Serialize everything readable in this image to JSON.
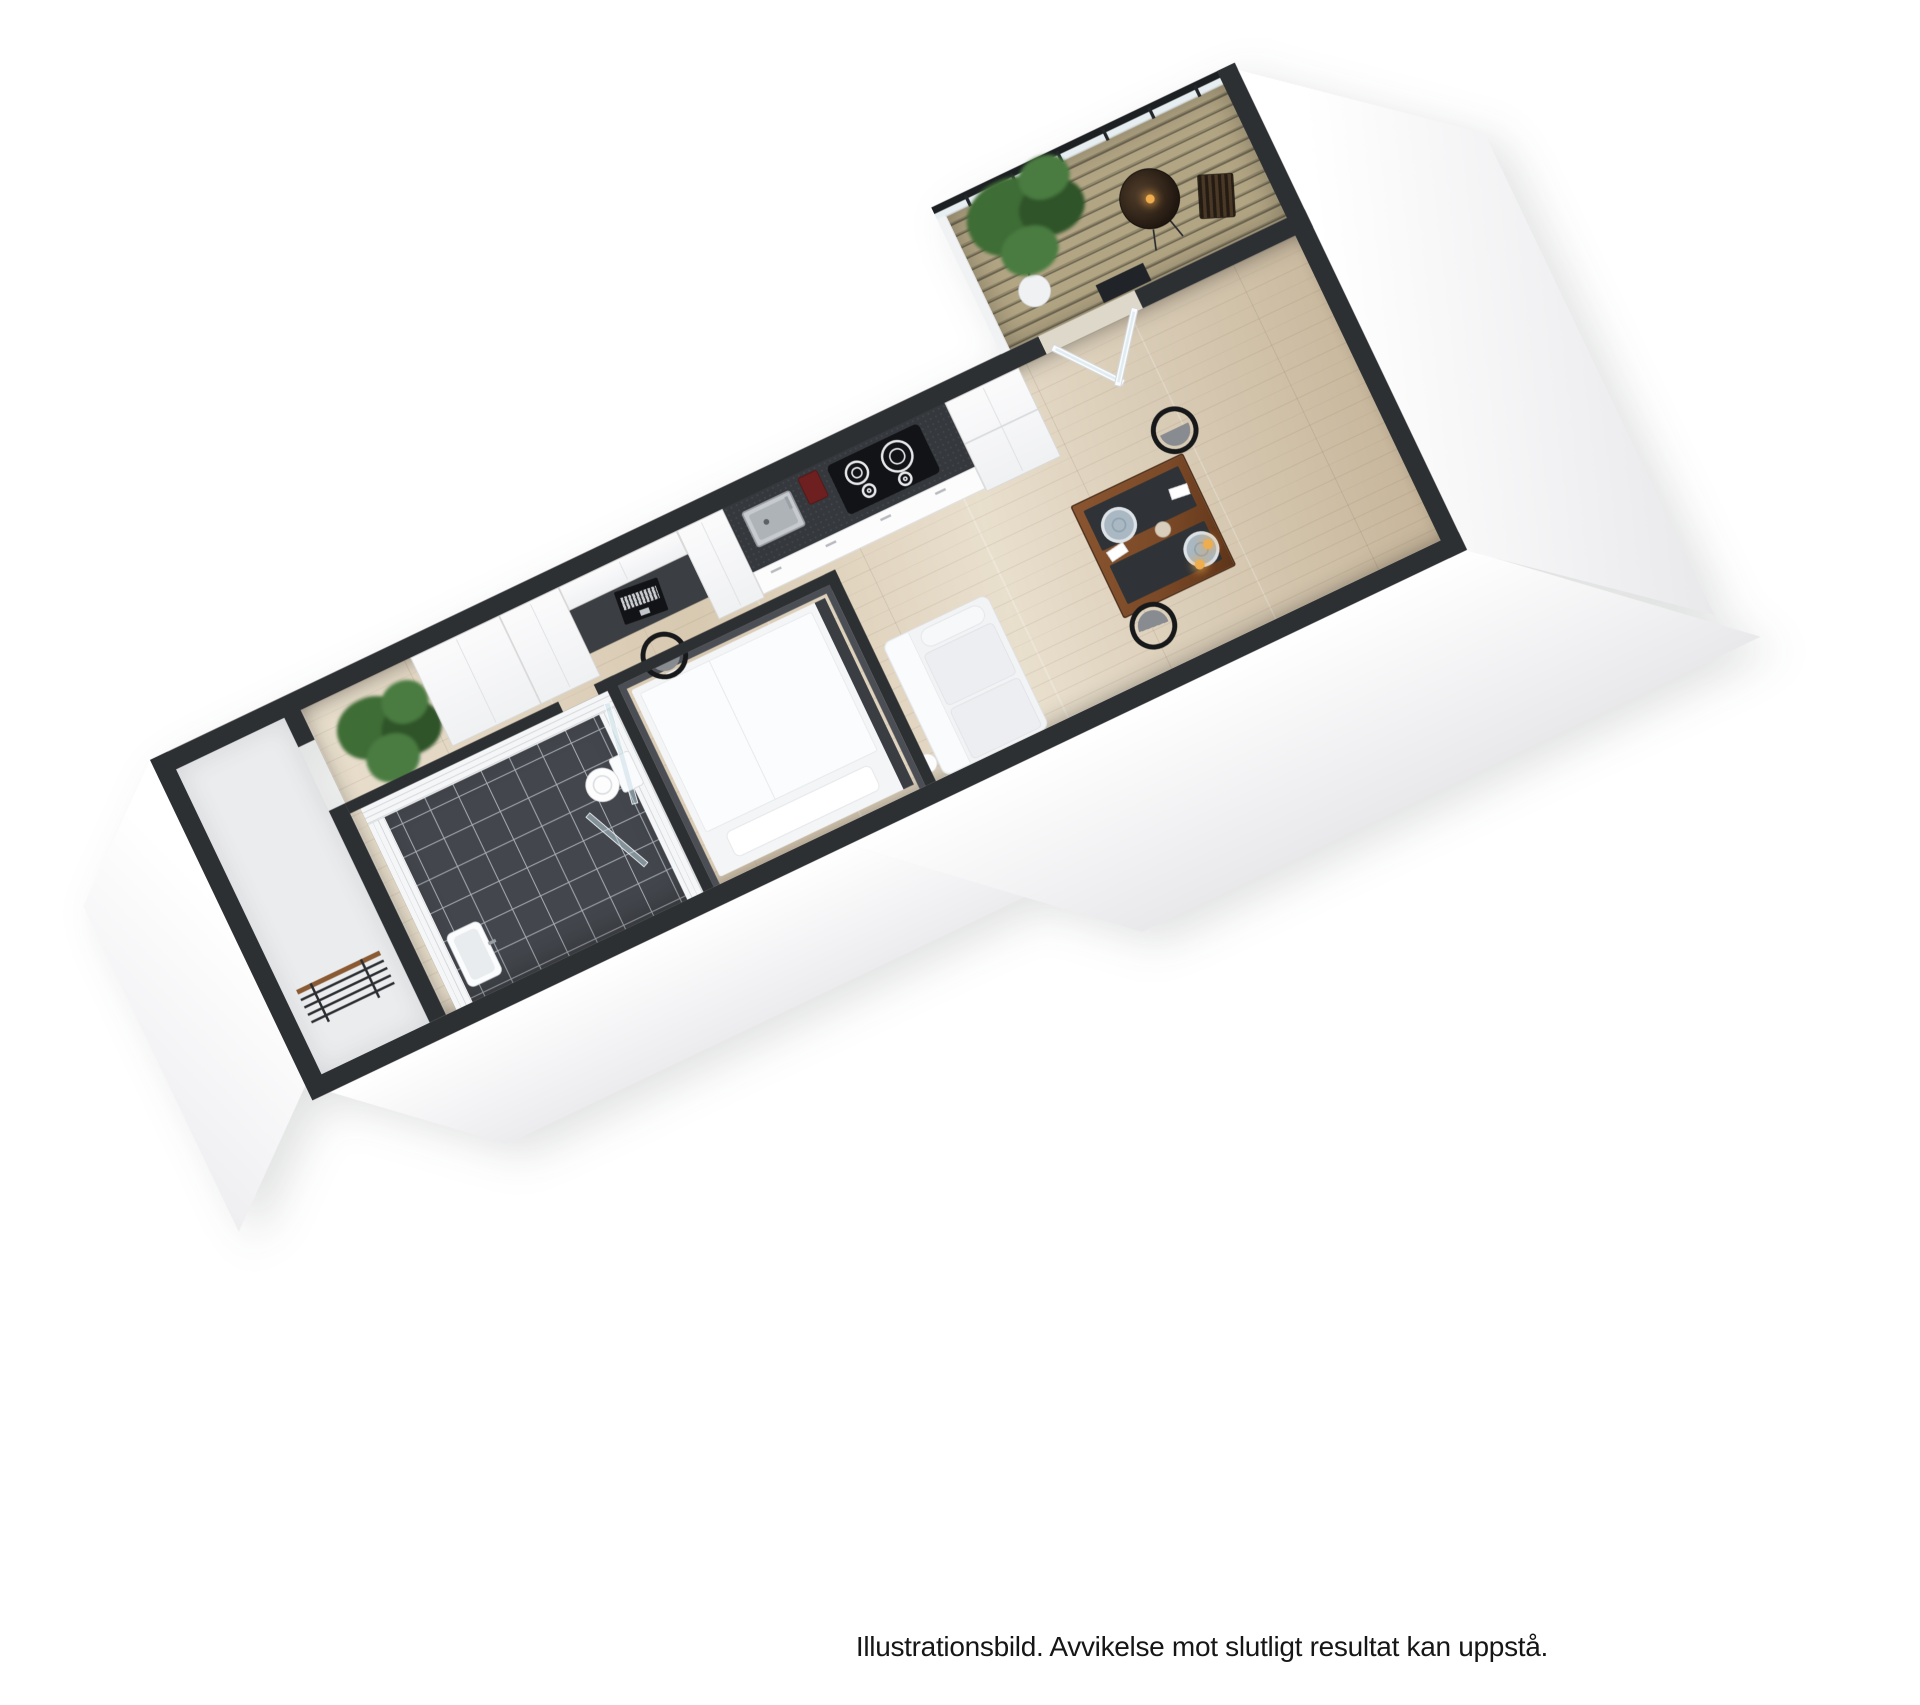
{
  "caption": "Illustrationsbild. Avvikelse mot slutligt resultat kan uppstå.",
  "palette": {
    "bg": "#ffffff",
    "text": "#161616",
    "wall": "#2d3033",
    "railing": "#1d2023",
    "wood": "#d8c9b1",
    "wood-dark": "#c6b59a",
    "wood-light": "#e9dfcd",
    "porch": "#ebecee",
    "bath-floor": "#43464c",
    "bath-grout": "#aab0b6",
    "tile": "#f5f6f7",
    "counter": "#35383c",
    "cooktop": "#111316",
    "cabinet-edge": "#d8dadc",
    "desk": "#3b3e42",
    "laptop": "#111316",
    "chair": "#17181a",
    "chair-pad": "#888b90",
    "table-wood": "#7c4a28",
    "placemat": "#2f3337",
    "plate": "#a9b8c2",
    "plate-rim": "#dde3e7",
    "candle": "#efae4e",
    "sofa": "#f2f3f5",
    "bed": "#f4f5f7",
    "bed-frame": "#3a3e43",
    "plant": "#3f6d36",
    "plant-dark": "#2f5429",
    "pot": "#f0f1f2",
    "deck": "#b2a584",
    "deck-dark": "#948a6d",
    "glass": "rgba(200,222,232,0.55)",
    "door": "#fbfcfd",
    "coffee": "#6e1f1f",
    "steel": "#c7cbcf",
    "rack-wood": "#8a5a33"
  },
  "scene": {
    "type": "3d-floor-plan-render",
    "rooms": [
      "entry porch",
      "hallway",
      "bathroom",
      "sleeping alcove",
      "kitchen",
      "living area",
      "dining area",
      "balcony"
    ],
    "furniture": [
      "coat-rack",
      "palm-plant",
      "bathroom-sink",
      "toilet",
      "shower-glass",
      "bed",
      "ball-lamp",
      "wardrobes",
      "overhead-cabinet",
      "desk",
      "laptop",
      "desk-chair",
      "kitchen-counter",
      "kitchen-sink",
      "coffee-machine",
      "cooktop",
      "drawer-fronts",
      "fridge",
      "sofa",
      "dining-table",
      "placemats",
      "plates",
      "cup",
      "candles",
      "napkins",
      "dining-chairs",
      "balcony-doors",
      "balcony-tree",
      "bistro-table",
      "slat-chair",
      "planter",
      "railing"
    ]
  }
}
